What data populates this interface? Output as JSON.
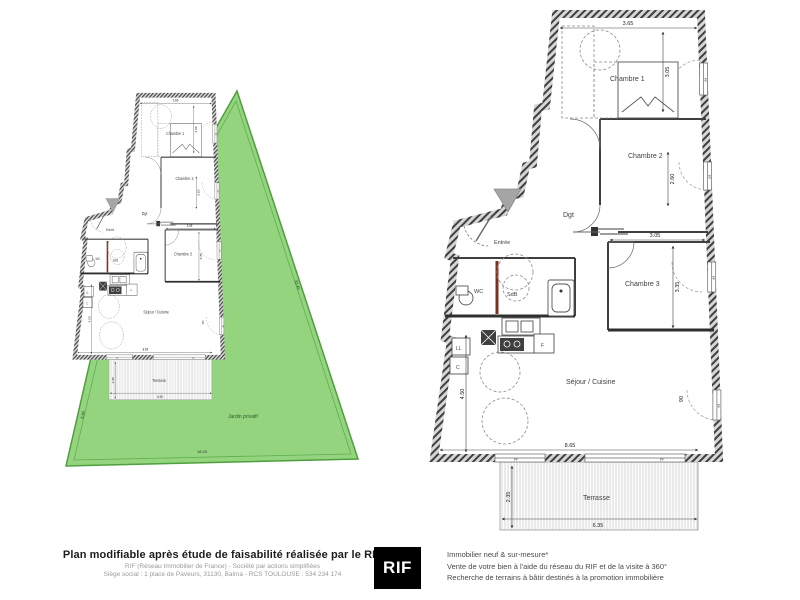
{
  "plans": {
    "rooms": {
      "chambre1": "Chambre 1",
      "chambre2": "Chambre 2",
      "chambre3": "Chambre 3",
      "dgt": "Dgt",
      "entree": "Entrée",
      "wc": "WC",
      "sdb": "SdB",
      "sejour_cuisine": "Séjour / Cuisine",
      "terrasse": "Terrasse",
      "jardin_privatif": "Jardin privatif"
    },
    "appliances": {
      "lave_linge": "LL",
      "cellier": "C",
      "frigo": "F"
    },
    "window_label": "PF",
    "dimensions": {
      "chambre1_width": "3.65",
      "chambre1_height": "3.05",
      "chambre2_window": "2.60",
      "chambre2_width": "3.05",
      "chambre3_height": "3.35",
      "sejour_width": "8.65",
      "sejour_height": "4.50",
      "door_width": "90",
      "terrasse_depth": "2.35",
      "terrasse_width": "6.35",
      "jardin_bottom": "18.25",
      "jardin_right": "33.45",
      "jardin_left": "6.60"
    }
  },
  "footer": {
    "left": {
      "title": "Plan modifiable après étude de faisabilité réalisée par le RIF",
      "line2": "RIF (Réseau Immobilier de France) - Société par actions simplifiées",
      "line3": "Siège social : 1 place de Paveurs, 31130, Balma - RCS TOULOUSE : 534 234 174"
    },
    "logo": "RIF",
    "right": {
      "line1": "Immobilier neuf & sur-mesure*",
      "line2": "Vente de votre bien à l'aide du réseau du RIF et de la visite à 360°",
      "line3": "Recherche de terrains à bâtir destinés à la promotion immobilière"
    }
  },
  "colors": {
    "garden_fill": "#94d47f",
    "garden_stroke": "#4f9f3f",
    "wall_dark": "#3f3f3f",
    "accent_red": "#7e2f1f",
    "marker_gray": "#a5a5a5"
  }
}
